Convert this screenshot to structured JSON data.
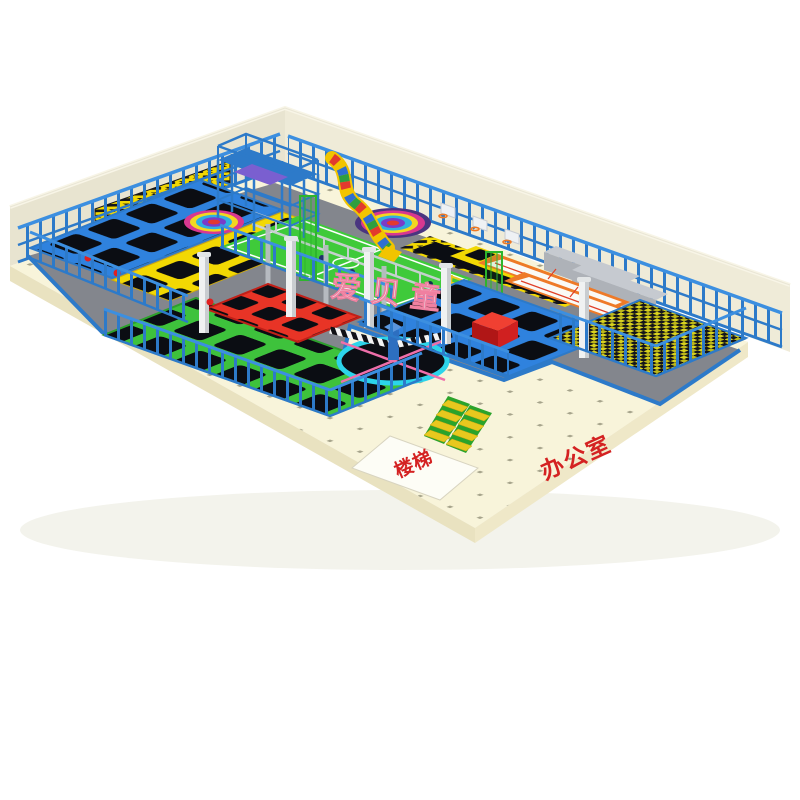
{
  "scene": {
    "description": "3D isometric render of an indoor trampoline park on a white background",
    "watermark": {
      "text": "爱贝童",
      "fill": "#ffffff",
      "outline": "#f080a0"
    },
    "floor_labels": {
      "stairs": {
        "text": "楼梯",
        "color": "#d42222"
      },
      "office": {
        "text": "办公室",
        "color": "#d42222"
      }
    },
    "colors": {
      "background": "#ffffff",
      "floor": "#f8f4da",
      "wall_back": "#efebd8",
      "wall_left": "#e8e4d0",
      "structure_blue": "#2d7ac9",
      "frame_blue": "#2f82de",
      "frame_green": "#3ec23c",
      "frame_yellow": "#f2d803",
      "frame_red": "#e83426",
      "trampoline_bed": "#0b0d13",
      "deck_gray": "#83868d",
      "court_orange": "#ee7a28",
      "court_green": "#3fca3a",
      "foam_yellow": "#d8d21e",
      "ring_cyan": "#2cd4ea",
      "line_pink": "#ef6faa",
      "slide_yellow": "#f2c400",
      "stair_green": "#2ba32b",
      "stair_yellow": "#e8c81e",
      "pillar_white": "#f0f2f2",
      "red_block": "#e03030"
    },
    "zones": [
      "wall-trampoline-bank",
      "yellow-trampoline-grid",
      "green-trampoline-grid",
      "red-trampoline-grid",
      "blue-trampoline-grid",
      "soccer-court",
      "slam-dunk-lane",
      "ninja-course",
      "orange-ball-courts",
      "foam-pit",
      "wipeout-spinner",
      "rainbow-targets",
      "slide-tower",
      "stairs",
      "office-area"
    ]
  }
}
